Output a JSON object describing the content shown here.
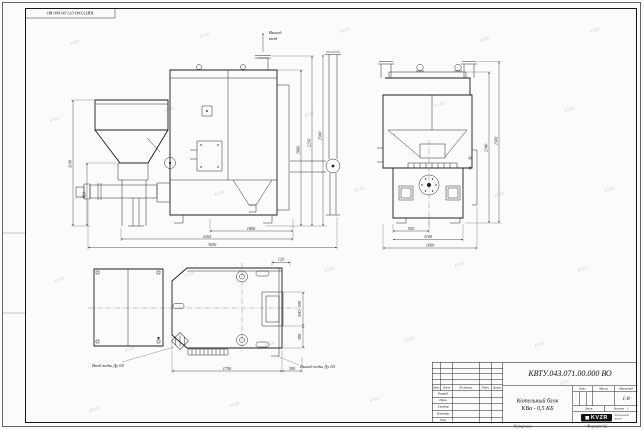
{
  "page": {
    "doc_number_rotated": "КВТУ.043.071.00.000 ВО",
    "watermark_text": "KVZR",
    "footer_copied": "Копировал",
    "footer_format": "Формат А2"
  },
  "labels": {
    "air_out_line1": "Выход",
    "air_out_line2": "возд",
    "water_inlet": "Вход воды Ду 65",
    "water_outlet": "Выход воды Ду 65"
  },
  "dims": {
    "front": {
      "hopper_height": "1190",
      "auger_height": "821",
      "body_height": "2086",
      "vent_height": "2250",
      "total_height": "2500",
      "grate_width": "1800",
      "mid_width": "2165",
      "total_width": "3050"
    },
    "side": {
      "body_height": "2140",
      "total_height": "2500",
      "width_1": "550",
      "width_2": "1100",
      "width_3": "1600"
    },
    "plan": {
      "rear_offset": "120",
      "hatch_size": "500×500",
      "stub_offset": "300",
      "body_length": "1750",
      "stub_length": "395"
    }
  },
  "title_block": {
    "doc_number": "КВТУ.043.071.00.000 ВО",
    "product_name_line1": "Котельный блок",
    "product_name_line2": "КВа - 0,5 КБ",
    "scale_value": "1:8",
    "sheets_value": "1",
    "headers": {
      "lit": "Лит.",
      "mass": "Масса",
      "scale": "Масштаб",
      "sheet": "Лист",
      "sheets": "Листов"
    },
    "sig_cols": [
      "Изм.",
      "Лист",
      "№ докум.",
      "Подп.",
      "Дата"
    ],
    "sig_rows": [
      "Разраб.",
      "Пров.",
      "Т.контр.",
      "Н.контр.",
      "Утв."
    ],
    "logo_text": "KVZR",
    "logo_tagline_line1": "Котельный",
    "logo_tagline_line2": "завод"
  }
}
